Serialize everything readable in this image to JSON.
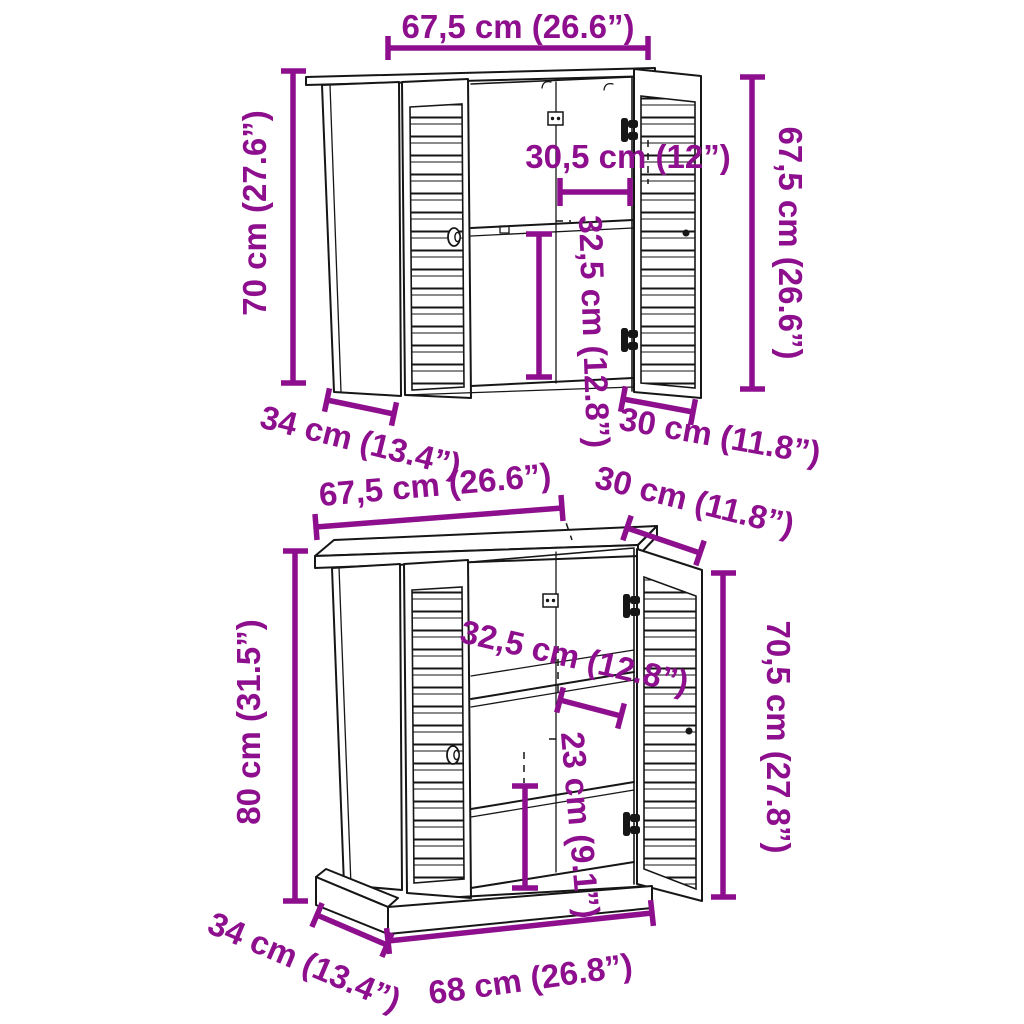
{
  "palette": {
    "dimension_color": "#8D0F8D",
    "line_color": "#161616",
    "background": "#ffffff"
  },
  "top_cabinet": {
    "dims": {
      "width_top": "67,5 cm (26.6”)",
      "height_left": "70 cm (27.6”)",
      "height_right": "67,5 cm (26.6”)",
      "inner_width": "30,5 cm (12”)",
      "inner_height": "32,5 cm (12.8”)",
      "depth_left": "34 cm (13.4”)",
      "depth_right": "30 cm (11.8”)"
    }
  },
  "bottom_cabinet": {
    "dims": {
      "width_top": "67,5 cm (26.6”)",
      "depth_top_right": "30 cm (11.8”)",
      "height_left": "80 cm (31.5”)",
      "height_right": "70,5 cm (27.8”)",
      "inner_height_upper": "32,5 cm (12.8”)",
      "inner_height_lower": "23 cm (9.1”)",
      "depth_left": "34 cm (13.4”)",
      "width_base": "68 cm (26.8”)"
    }
  }
}
